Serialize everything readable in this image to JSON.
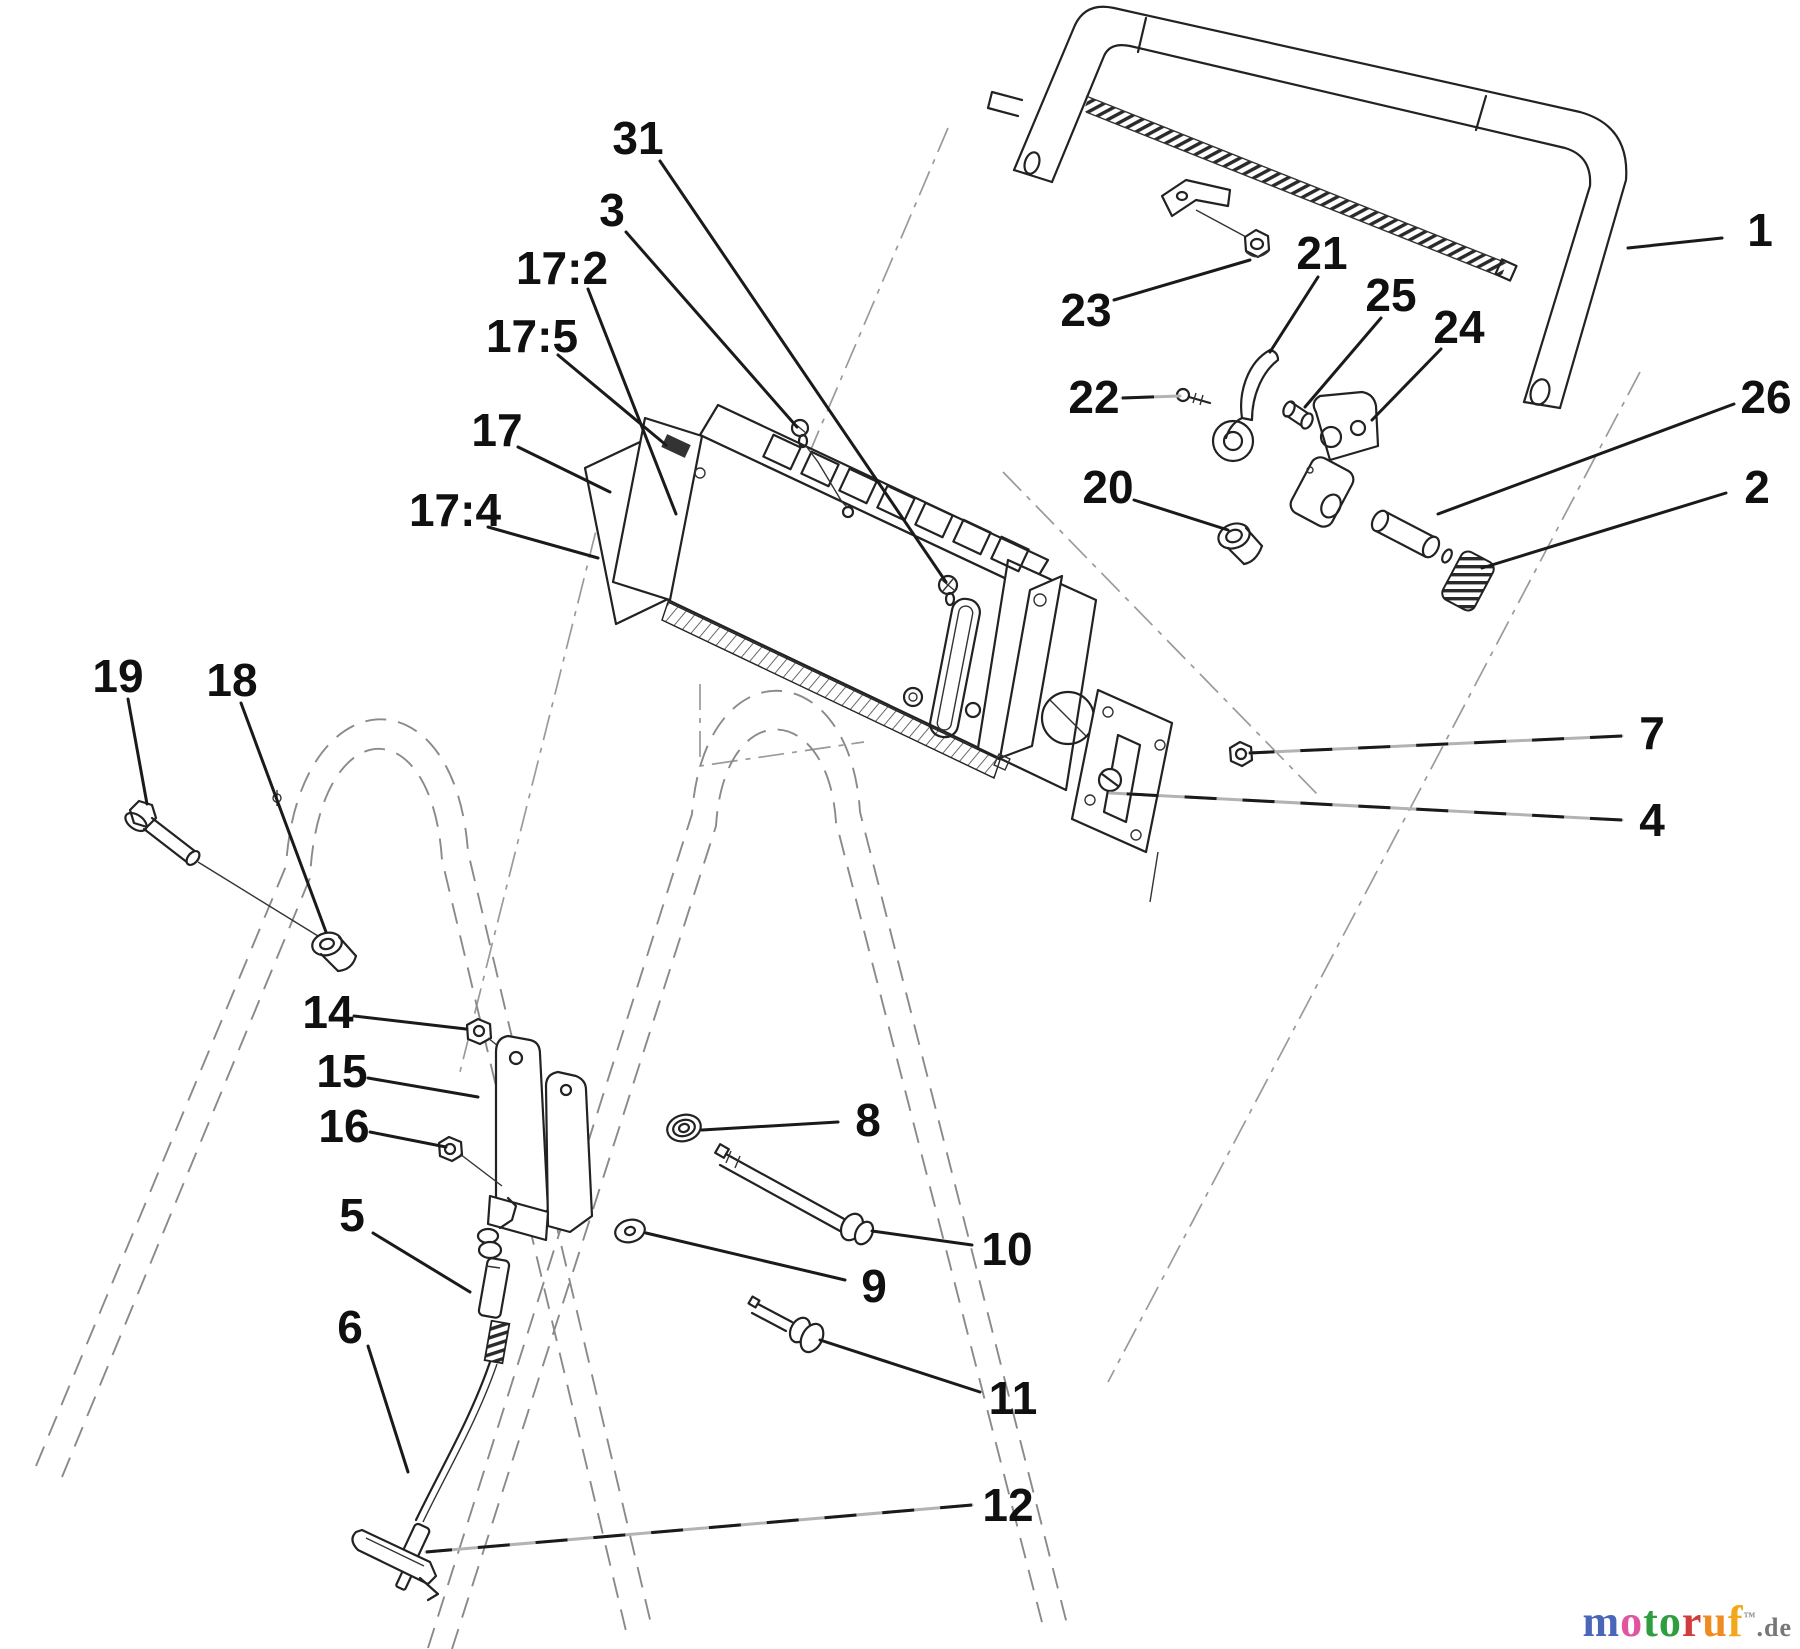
{
  "figure": {
    "kind": "exploded-parts-diagram",
    "subject": "walk-behind mower upper handle and control panel assembly",
    "background_color": "#ffffff",
    "line_color": "#222222"
  },
  "callouts": [
    {
      "label": "1",
      "x": 1760,
      "y": 230,
      "sx": 1722,
      "sy": 238,
      "tx": 1628,
      "ty": 248,
      "dashed": false
    },
    {
      "label": "2",
      "x": 1757,
      "y": 487,
      "sx": 1726,
      "sy": 493,
      "tx": 1482,
      "ty": 568,
      "dashed": false
    },
    {
      "label": "3",
      "x": 612,
      "y": 210,
      "sx": 626,
      "sy": 232,
      "tx": 797,
      "ty": 427,
      "dashed": false
    },
    {
      "label": "4",
      "x": 1652,
      "y": 820,
      "sx": 1622,
      "sy": 820,
      "tx": 1110,
      "ty": 793,
      "dashed": true
    },
    {
      "label": "5",
      "x": 352,
      "y": 1215,
      "sx": 373,
      "sy": 1233,
      "tx": 470,
      "ty": 1292,
      "dashed": false
    },
    {
      "label": "6",
      "x": 350,
      "y": 1327,
      "sx": 368,
      "sy": 1346,
      "tx": 408,
      "ty": 1472,
      "dashed": false
    },
    {
      "label": "7",
      "x": 1652,
      "y": 733,
      "sx": 1622,
      "sy": 736,
      "tx": 1249,
      "ty": 753,
      "dashed": true
    },
    {
      "label": "8",
      "x": 868,
      "y": 1120,
      "sx": 838,
      "sy": 1122,
      "tx": 702,
      "ty": 1130,
      "dashed": false
    },
    {
      "label": "9",
      "x": 874,
      "y": 1286,
      "sx": 845,
      "sy": 1280,
      "tx": 646,
      "ty": 1233,
      "dashed": false
    },
    {
      "label": "10",
      "x": 1007,
      "y": 1249,
      "sx": 972,
      "sy": 1245,
      "tx": 872,
      "ty": 1231,
      "dashed": false
    },
    {
      "label": "11",
      "x": 1013,
      "y": 1398,
      "sx": 980,
      "sy": 1392,
      "tx": 820,
      "ty": 1340,
      "dashed": false
    },
    {
      "label": "12",
      "x": 1008,
      "y": 1505,
      "sx": 972,
      "sy": 1505,
      "tx": 426,
      "ty": 1552,
      "dashed": true
    },
    {
      "label": "14",
      "x": 328,
      "y": 1012,
      "sx": 354,
      "sy": 1016,
      "tx": 466,
      "ty": 1029,
      "dashed": false
    },
    {
      "label": "15",
      "x": 342,
      "y": 1071,
      "sx": 368,
      "sy": 1078,
      "tx": 478,
      "ty": 1097,
      "dashed": false
    },
    {
      "label": "16",
      "x": 344,
      "y": 1126,
      "sx": 370,
      "sy": 1132,
      "tx": 446,
      "ty": 1147,
      "dashed": false
    },
    {
      "label": "17",
      "x": 497,
      "y": 430,
      "sx": 518,
      "sy": 447,
      "tx": 610,
      "ty": 492,
      "dashed": false
    },
    {
      "label": "17:2",
      "x": 562,
      "y": 268,
      "sx": 588,
      "sy": 289,
      "tx": 676,
      "ty": 514,
      "dashed": false
    },
    {
      "label": "17:4",
      "x": 455,
      "y": 510,
      "sx": 488,
      "sy": 527,
      "tx": 598,
      "ty": 558,
      "dashed": false
    },
    {
      "label": "17:5",
      "x": 532,
      "y": 336,
      "sx": 558,
      "sy": 355,
      "tx": 666,
      "ty": 445,
      "dashed": false
    },
    {
      "label": "18",
      "x": 232,
      "y": 680,
      "sx": 241,
      "sy": 703,
      "tx": 326,
      "ty": 932,
      "dashed": false
    },
    {
      "label": "19",
      "x": 118,
      "y": 676,
      "sx": 128,
      "sy": 699,
      "tx": 147,
      "ty": 804,
      "dashed": false
    },
    {
      "label": "20",
      "x": 1108,
      "y": 487,
      "sx": 1134,
      "sy": 500,
      "tx": 1228,
      "ty": 530,
      "dashed": false
    },
    {
      "label": "21",
      "x": 1322,
      "y": 253,
      "sx": 1318,
      "sy": 277,
      "tx": 1270,
      "ty": 352,
      "dashed": false
    },
    {
      "label": "22",
      "x": 1094,
      "y": 397,
      "sx": 1122,
      "sy": 398,
      "tx": 1180,
      "ty": 396,
      "dashed": true
    },
    {
      "label": "23",
      "x": 1086,
      "y": 310,
      "sx": 1114,
      "sy": 300,
      "tx": 1250,
      "ty": 260,
      "dashed": false
    },
    {
      "label": "24",
      "x": 1459,
      "y": 327,
      "sx": 1441,
      "sy": 349,
      "tx": 1372,
      "ty": 420,
      "dashed": false
    },
    {
      "label": "25",
      "x": 1391,
      "y": 295,
      "sx": 1381,
      "sy": 318,
      "tx": 1305,
      "ty": 407,
      "dashed": false
    },
    {
      "label": "26",
      "x": 1766,
      "y": 397,
      "sx": 1734,
      "sy": 404,
      "tx": 1438,
      "ty": 514,
      "dashed": false
    },
    {
      "label": "31",
      "x": 638,
      "y": 138,
      "sx": 660,
      "sy": 161,
      "tx": 946,
      "ty": 582,
      "dashed": false
    }
  ],
  "watermark": {
    "letters": [
      {
        "ch": "m",
        "color": "#4a66b8"
      },
      {
        "ch": "o",
        "color": "#e0559f"
      },
      {
        "ch": "t",
        "color": "#2f9e3f"
      },
      {
        "ch": "o",
        "color": "#2f9e3f"
      },
      {
        "ch": "r",
        "color": "#d23c3c"
      },
      {
        "ch": "u",
        "color": "#ef8b1f"
      },
      {
        "ch": "f",
        "color": "#f3a81c"
      }
    ],
    "tm_mark": "™",
    "suffix": ".de",
    "suffix_color": "#777777"
  }
}
